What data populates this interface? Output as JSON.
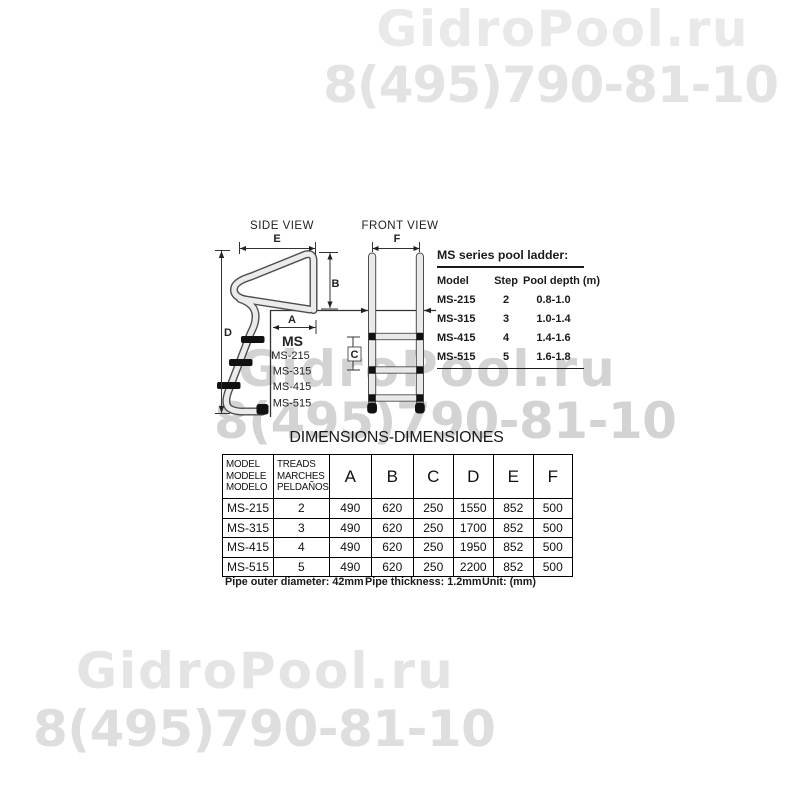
{
  "colors": {
    "watermark_top": "#e9e9e9",
    "watermark_middle": "#d3d3d3",
    "watermark_bottom": "#e4e4e4",
    "drawing_outline": "#4d4d4d",
    "tube_fill": "#e9e9e9",
    "text": "#1a1a1a"
  },
  "watermark": {
    "brand": "GidroPool.ru",
    "phone": "8(495)790-81-10"
  },
  "diagram": {
    "side_view_label": "SIDE VIEW",
    "front_view_label": "FRONT VIEW",
    "series_label": "MS",
    "series_models": [
      "MS-215",
      "MS-315",
      "MS-415",
      "MS-515"
    ],
    "dims": {
      "A": "A",
      "B": "B",
      "C": "C",
      "D": "D",
      "E": "E",
      "F": "F"
    }
  },
  "spec_table": {
    "title": "MS series pool ladder:",
    "headers": {
      "model": "Model",
      "step": "Step",
      "depth": "Pool depth  (m)"
    },
    "rows": [
      {
        "model": "MS-215",
        "step": "2",
        "depth": "0.8-1.0"
      },
      {
        "model": "MS-315",
        "step": "3",
        "depth": "1.0-1.4"
      },
      {
        "model": "MS-415",
        "step": "4",
        "depth": "1.4-1.6"
      },
      {
        "model": "MS-515",
        "step": "5",
        "depth": "1.6-1.8"
      }
    ]
  },
  "dimensions_table": {
    "title": "DIMENSIONS-DIMENSIONES",
    "model_header": [
      "MODEL",
      "MODELE",
      "MODELO"
    ],
    "treads_header": [
      "TREADS",
      "MARCHES",
      "PELDAÑOS"
    ],
    "dim_columns": [
      "A",
      "B",
      "C",
      "D",
      "E",
      "F"
    ],
    "rows": [
      {
        "model": "MS-215",
        "treads": "2",
        "A": "490",
        "B": "620",
        "C": "250",
        "D": "1550",
        "E": "852",
        "F": "500"
      },
      {
        "model": "MS-315",
        "treads": "3",
        "A": "490",
        "B": "620",
        "C": "250",
        "D": "1700",
        "E": "852",
        "F": "500"
      },
      {
        "model": "MS-415",
        "treads": "4",
        "A": "490",
        "B": "620",
        "C": "250",
        "D": "1950",
        "E": "852",
        "F": "500"
      },
      {
        "model": "MS-515",
        "treads": "5",
        "A": "490",
        "B": "620",
        "C": "250",
        "D": "2200",
        "E": "852",
        "F": "500"
      }
    ]
  },
  "notes": {
    "pipe_outer": "Pipe outer diameter:  42mm",
    "pipe_thickness": "Pipe  thickness:  1.2mm",
    "unit": "Unit: (mm)"
  }
}
